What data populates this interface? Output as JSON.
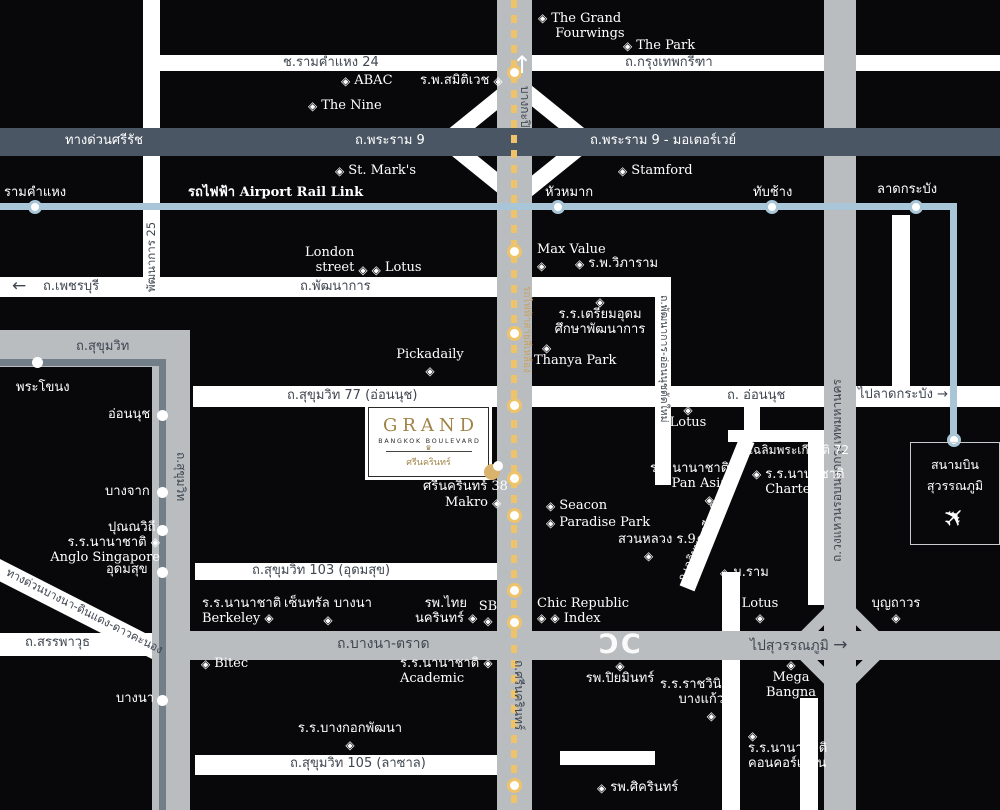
{
  "colors": {
    "bg": "#08080a",
    "road_white": "#ffffff",
    "road_gray": "#b9bdc0",
    "rama9_band": "#4a5663",
    "arl_blue": "#a9c6d8",
    "yellow_line": "#eec36a",
    "gold_text": "#c7a264",
    "logo_gold": "#a08347",
    "dark_label": "#3f4650"
  },
  "icons": {
    "poi_marker": "◈",
    "arrow_up": "↑",
    "arrow_left": "←",
    "arrow_right": "→",
    "plane": "✈",
    "interchange_left": "Ɔ",
    "interchange_right": "C",
    "crown": "♛"
  },
  "roads": {
    "ram24": "ช.รามคำแหง 24",
    "krungthep_kreetha": "ถ.กรุงเทพกรีฑา",
    "srirat_expwy": "ทางด่วนศรีรัช",
    "rama9": "ถ.พระราม 9",
    "rama9_motorway": "ถ.พระราม 9 - มอเตอร์เวย์",
    "phetchaburi": "ถ.เพชรบุรี",
    "phatthanakan": "ถ.พัฒนาการ",
    "phatthanakan25": "พัฒนาการ 25",
    "phatthanakan_onnut_new": "ถ.พัฒนาการ-อ่อนนุชตัดใหม่",
    "sukhumvit": "ถ.สุขุมวิท",
    "sukhumvit_vertical": "ถ.สุขุมวิท",
    "sukhumvit77": "ถ.สุขุมวิท 77 (อ่อนนุช)",
    "onnut": "ถ. อ่อนนุช",
    "to_latkrabang": "ไปลาดกระบัง",
    "chalermprakiat72": "ช.เฉลิมพระเกียรติ 72",
    "chalermprakiat9": "ถ.เฉลิมพระเกียรติ ร.9",
    "sukhumvit103": "ถ.สุขุมวิท 103 (อุดมสุข)",
    "bangna_trad": "ถ.บางนา-ตราด",
    "to_suvarnabhumi": "ไปสุวรรณภูมิ",
    "sanphawut": "ถ.สรรพาวุธ",
    "bangna_expwy": "ทางด่วนบางนา-ดินแดง-ดาวคะนอง",
    "sukhumvit105": "ถ.สุขุมวิท 105 (ลาซาล)",
    "srinagarindra": "ถ.ศรีนครินทร์",
    "ring_road": "ถ.วงแหวนรอบนอกกรุงเทพมหานคร",
    "bangkapi": "บางกะปิ"
  },
  "transit": {
    "arl_line_label": "รถไฟฟ้า Airport Rail Link",
    "yellow_line_label": "รถไฟฟ้าสายสีเหลือง",
    "arl_stations": {
      "ramkhamhaeng": "รามคำแหง",
      "huamak": "หัวหมาก",
      "thapchang": "ทับช้าง",
      "latkrabang": "ลาดกระบัง"
    },
    "bts_stations": {
      "phrakhanong": "พระโขนง",
      "onnut": "อ่อนนุช",
      "bangchak": "บางจาก",
      "punnawithi": "ปุณณวิถี",
      "udomsuk": "อุดมสุข",
      "bangna": "บางนา"
    },
    "airport_line1": "สนามบิน",
    "airport_line2": "สุวรรณภูมิ"
  },
  "logo": {
    "brand": "GRAND",
    "subtitle": "BANGKOK BOULEVARD",
    "thai": "ศรีนครินทร์",
    "soi": "ศรีนครินทร์ 38"
  },
  "pois": {
    "grand_fourwings": [
      "The Grand",
      "Fourwings"
    ],
    "the_park": "The Park",
    "abac": "ABAC",
    "samitivej": "ร.พ.สมิติเวช",
    "the_nine": "The Nine",
    "st_marks": "St. Mark's",
    "stamford": "Stamford",
    "london_street": [
      "London",
      "street"
    ],
    "lotus_phatthanakan": "Lotus",
    "max_value": "Max Value",
    "vibharam": "ร.พ.วิภาราม",
    "triam_udom": [
      "ร.ร.เตรียมอุดม",
      "ศึกษาพัฒนาการ"
    ],
    "thanya_park": "Thanya Park",
    "pickadaily": "Pickadaily",
    "lotus_onnut": "Lotus",
    "pan_asia": [
      "ร.ร.นานาชาติ",
      "Pan Asia"
    ],
    "charter": [
      "ร.ร.นานาชาติ",
      "Charter"
    ],
    "seacon": "Seacon",
    "paradise_park": "Paradise Park",
    "suan_luang": "สวนหลวง ร.9",
    "m_ram": "ม.ราม",
    "makro": "Makro",
    "anglo": [
      "ร.ร.นานาชาติ",
      "Anglo Singapore"
    ],
    "berkeley": [
      "ร.ร.นานาชาติ",
      "Berkeley"
    ],
    "central_bangna": "เซ็นทรัล บางนา",
    "thai_nakarin": [
      "รพ.ไทย",
      "นครินทร์"
    ],
    "sb": "SB",
    "chic_republic": "Chic Republic",
    "index": "Index",
    "bitec": "Bitec",
    "academic": [
      "ร.ร.นานาชาติ",
      "Academic"
    ],
    "bangkok_phatthana": "ร.ร.บางกอกพัฒนา",
    "sikarin": "รพ.ศิครินทร์",
    "piyamin": "รพ.ปิยมินทร์",
    "ratwinit": [
      "ร.ร.ราชวินิต",
      "บางแก้ว"
    ],
    "mega_bangna": [
      "Mega",
      "Bangna"
    ],
    "lotus_bangna": "Lotus",
    "boonthavorn": "บุญถาวร",
    "concordian": [
      "ร.ร.นานาชาติ",
      "คอนคอร์เดียน"
    ]
  }
}
